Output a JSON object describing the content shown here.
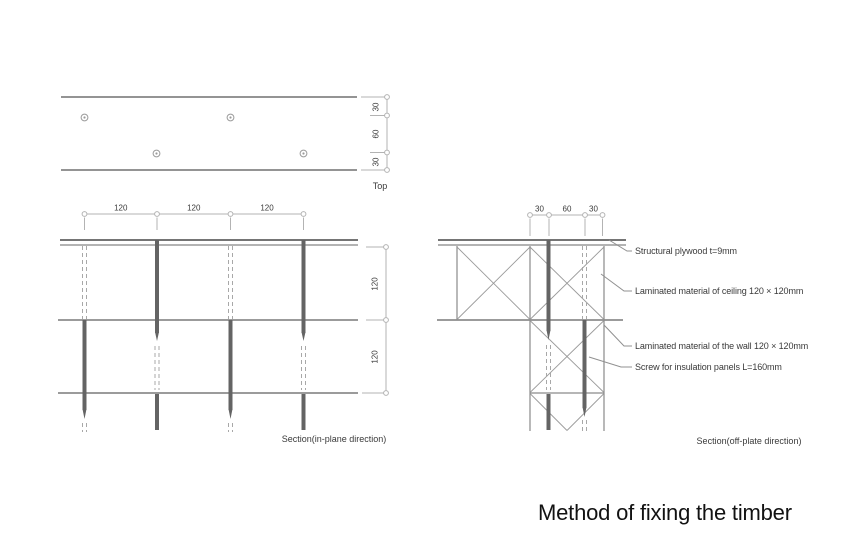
{
  "title": "Method of fixing the timber",
  "top_view": {
    "caption": "Top",
    "vertical_dims": [
      "30",
      "60",
      "30"
    ]
  },
  "in_plane_section": {
    "caption": "Section(in-plane direction)",
    "top_dims": [
      "120",
      "120",
      "120"
    ],
    "right_dims": [
      "120",
      "120"
    ]
  },
  "off_plate_section": {
    "caption": "Section(off-plate direction)",
    "top_dims": [
      "30",
      "60",
      "30"
    ],
    "annotations": [
      "Structural plywood t=9mm",
      "Laminated material of ceiling 120 × 120mm",
      "Laminated material of the wall 120 × 120mm",
      "Screw for insulation panels L=160mm"
    ]
  },
  "colors": {
    "drawing_line": "#7a7a7a",
    "plywood_line": "#757575",
    "screw": "#646464",
    "hidden_line": "#a8a8a8",
    "dimension_line": "#b3b3b3",
    "diagonal_line": "#9a9a9a",
    "text": "#3a3a3a",
    "title_text": "#121212"
  }
}
